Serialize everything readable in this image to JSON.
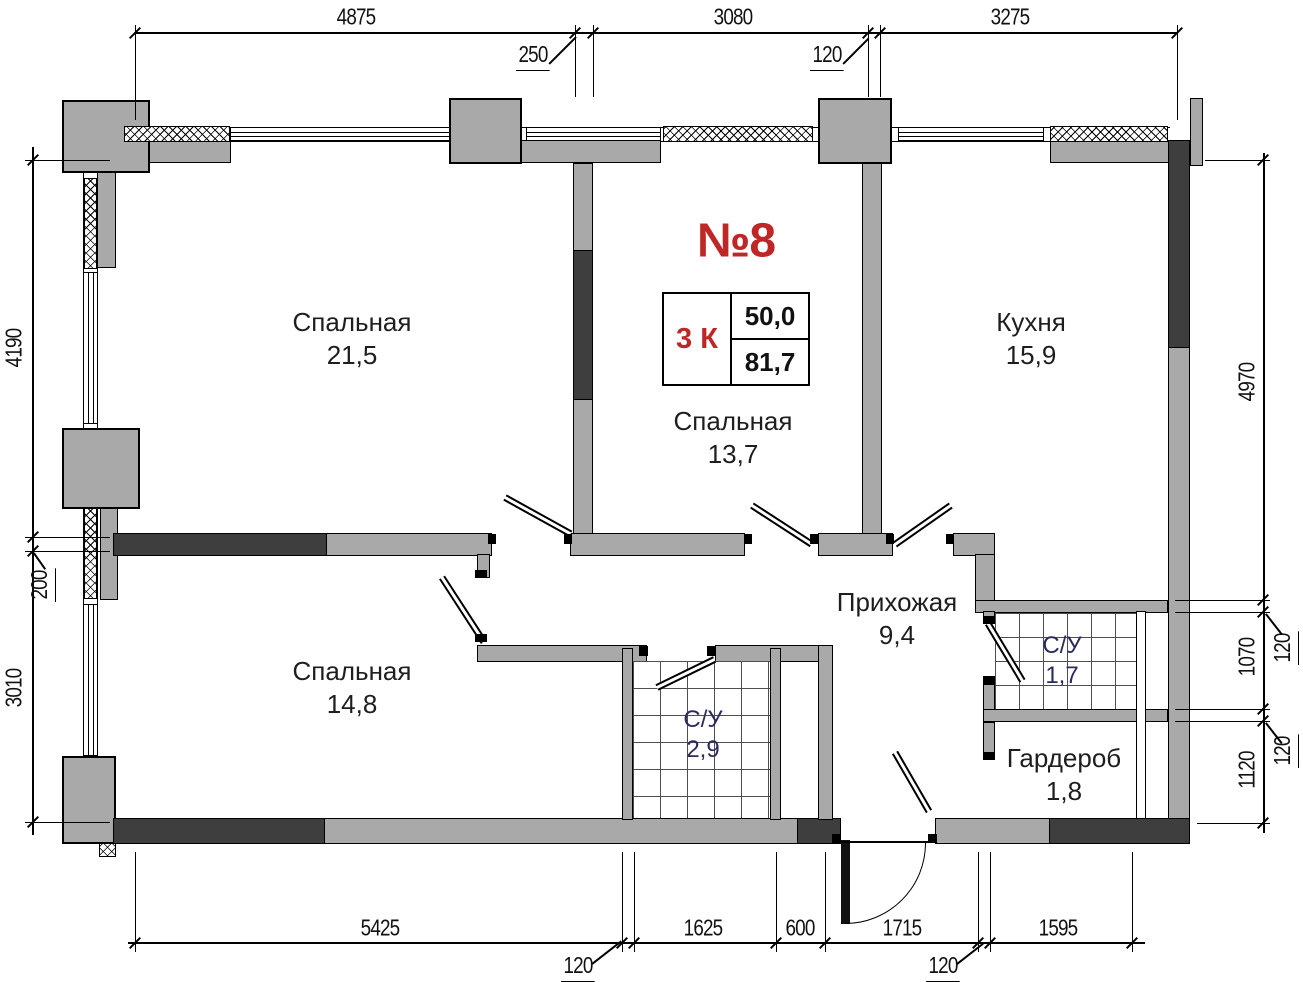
{
  "plan": {
    "apartment_number": "№8",
    "stamp": {
      "rooms": "3 К",
      "living_area": "50,0",
      "total_area": "81,7"
    },
    "rooms": [
      {
        "name": "Спальная",
        "area": "21,5"
      },
      {
        "name": "Спальная",
        "area": "13,7"
      },
      {
        "name": "Кухня",
        "area": "15,9"
      },
      {
        "name": "Спальная",
        "area": "14,8"
      },
      {
        "name": "Прихожая",
        "area": "9,4"
      },
      {
        "name": "С/У",
        "area": "1,7"
      },
      {
        "name": "С/У",
        "area": "2,9"
      },
      {
        "name": "Гардероб",
        "area": "1,8"
      }
    ],
    "dimensions": {
      "top": [
        "4875",
        "250",
        "3080",
        "120",
        "3275"
      ],
      "left": [
        "4190",
        "200",
        "3010"
      ],
      "right": [
        "4970",
        "1070",
        "120",
        "1120",
        "120"
      ],
      "bottom": [
        "5425",
        "120",
        "1625",
        "600",
        "1715",
        "120",
        "1595"
      ]
    },
    "colors": {
      "wall_gray": "#a9a9a9",
      "wall_dark": "#3e3e3e",
      "accent_red": "#bf2727",
      "bathroom_text": "#2b2b5e",
      "line": "#000000"
    }
  }
}
